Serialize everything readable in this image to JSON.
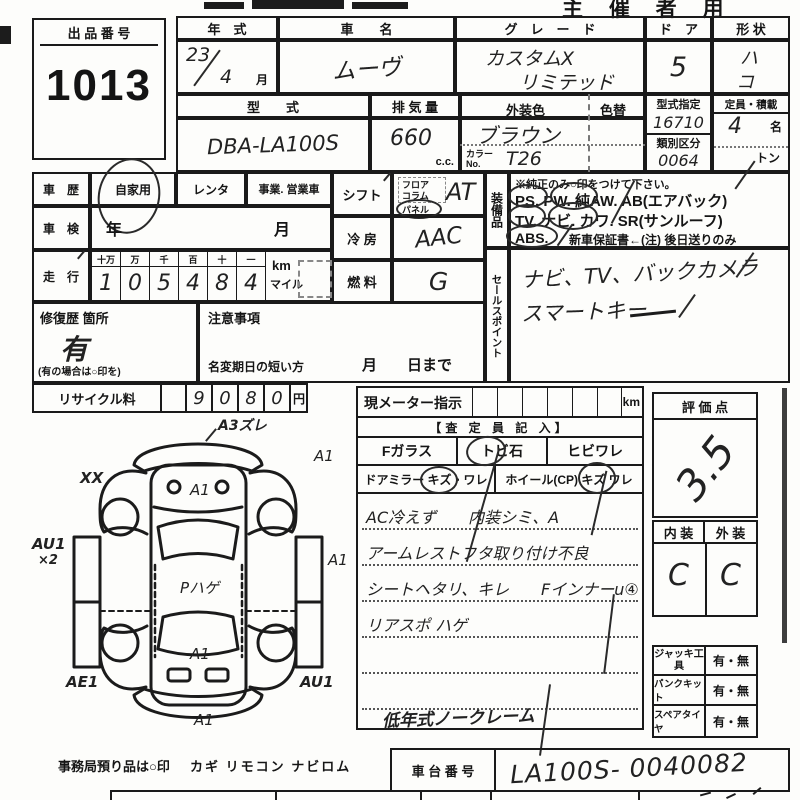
{
  "page": {
    "organizer_label": "主 催 者 用"
  },
  "lot": {
    "label": "出 品 番 号",
    "number": "1013"
  },
  "top": {
    "year_label": "年　式",
    "year": "23",
    "month": "4",
    "month_unit": "月",
    "name_label": "車　　名",
    "name": "ムーヴ",
    "grade_label": "グ　レ　ー　ド",
    "grade1": "カスタムX",
    "grade2": "リミテッド",
    "door_label": "ド　ア",
    "door": "5",
    "shape_label": "形 状",
    "shape1": "ハ",
    "shape2": "コ",
    "model_label": "型　　式",
    "model": "DBA-LA100S",
    "disp_label": "排 気 量",
    "disp": "660",
    "disp_unit": "c.c.",
    "color_label": "外装色",
    "color": "ブラウン",
    "color_change_label": "色替",
    "color_no_label": "カラーNo.",
    "color_no": "T26",
    "type_no_label": "型式指定",
    "type_no": "16710",
    "class_label": "類別区分",
    "class_no": "0064",
    "cap_label": "定員・積載",
    "cap": "4",
    "cap_unit": "名",
    "load_unit": "トン"
  },
  "history": {
    "label": "車　歴",
    "opt1": "自家用",
    "opt2": "レンタ",
    "opt3": "事業. 営業車"
  },
  "shaken": {
    "label": "車　検",
    "value": "年　　　月"
  },
  "mileage": {
    "label": "走　行",
    "h": [
      "十万",
      "万",
      "千",
      "百",
      "十",
      "一"
    ],
    "d": [
      "1",
      "0",
      "5",
      "4",
      "8",
      "4"
    ],
    "km": "km",
    "mile": "マイル"
  },
  "repair": {
    "label": "修復歴 箇所",
    "value": "有",
    "note": "(有の場合は○印を)"
  },
  "caution": {
    "label": "注意事項",
    "rename": "名変期日の短い方",
    "until": "月　　日まで"
  },
  "shift": {
    "label": "シフト",
    "floor": "フロア",
    "column": "コラム",
    "panel": "パネル",
    "value": "AT"
  },
  "cool": {
    "label": "冷 房",
    "value": "AAC"
  },
  "fuel": {
    "label": "燃 料",
    "value": "G"
  },
  "equip": {
    "label": "装備品",
    "note": "※純正のみ○印をつけて下さい。",
    "line1": "PS.  PW.  純AW.  AB(エアバック)",
    "line2": "TV.  ナビ.  カワ.  SR(サンルーフ)",
    "line3a": "ABS.",
    "line3b": "新車保証書←(注) 後日送りのみ",
    "circled": "PS PW TV ナビ ABS"
  },
  "sales": {
    "label": "セールスポイント",
    "line1": "ナビ、TV、バックカメラ",
    "line2": "スマートキー"
  },
  "recycle": {
    "label": "リサイクル料",
    "d": [
      "9",
      "0",
      "8",
      "0"
    ],
    "unit": "円"
  },
  "diagram": {
    "front": "A3ズレ",
    "xx": "XX",
    "hood": "A1",
    "rf": "A1",
    "ls": "AU1",
    "ls2": "×2",
    "rs": "A1",
    "roof": "Pハゲ",
    "deck": "A1",
    "lr": "AE1",
    "rr": "AU1",
    "rear": "A1"
  },
  "office": {
    "label": "事務局預り品は○印",
    "items": "カギ リモコン ナビロム"
  },
  "meter": {
    "label": "現メーター指示",
    "unit": "km"
  },
  "assessor": {
    "header": "【査 定 員 記 入】",
    "fglass": "Fガラス",
    "stone": "トビ石",
    "crack": "ヒビワレ",
    "mirror": "ドアミラー キズ・ワレ",
    "wheel": "ホイール(CP) キズ ワレ",
    "n1": "AC冷えず　　内装シミ、A",
    "n2": "アームレストフタ取り付け不良",
    "n3": "シートヘタリ、キレ　　Fインナーu④",
    "n4": "リアスポ ハゲ",
    "bottom": "低年式ノークレーム"
  },
  "chassis": {
    "label": "車 台 番 号",
    "value": "LA100S- 0040082"
  },
  "score": {
    "label": "評 価 点",
    "value": "3.5"
  },
  "inout": {
    "in_label": "内 装",
    "out_label": "外 装",
    "in": "C",
    "out": "C"
  },
  "tools": {
    "r1": "ジャッキ工具",
    "r2": "パンクキット",
    "r3": "スペアタイヤ",
    "v": "有・無"
  }
}
